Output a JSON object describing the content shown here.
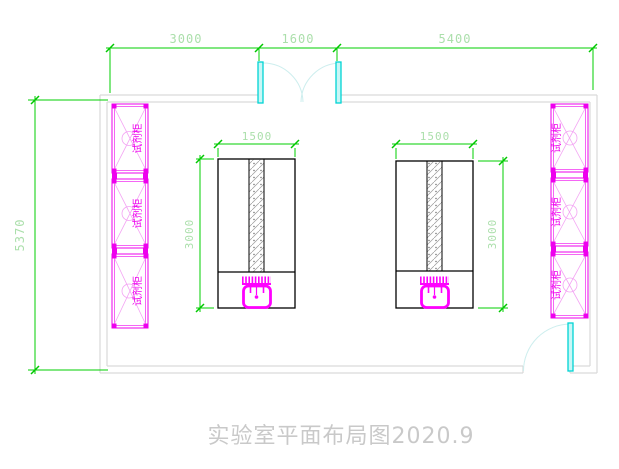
{
  "drawing": {
    "title": "实验室平面布局图2020.9",
    "dims": {
      "top_left": "3000",
      "top_middle": "1600",
      "top_right": "5400",
      "left_height": "5370",
      "bench_left_width": "1500",
      "bench_left_length": "3000",
      "bench_right_width": "1500",
      "bench_right_length": "3000"
    },
    "labels": {
      "cabinet": "试剂柜"
    },
    "colors": {
      "dimension_line": "#00cf00",
      "dimension_text": "#abdfab",
      "cabinet_magenta": "#ee00ee",
      "sink_magenta": "#ff00ff",
      "door_leaf": "#00d4d4",
      "door_arc": "#cdeeee",
      "wall_gray": "#d9d9d9",
      "bench_outline": "#000000",
      "title_gray": "#c9c9c9"
    }
  }
}
